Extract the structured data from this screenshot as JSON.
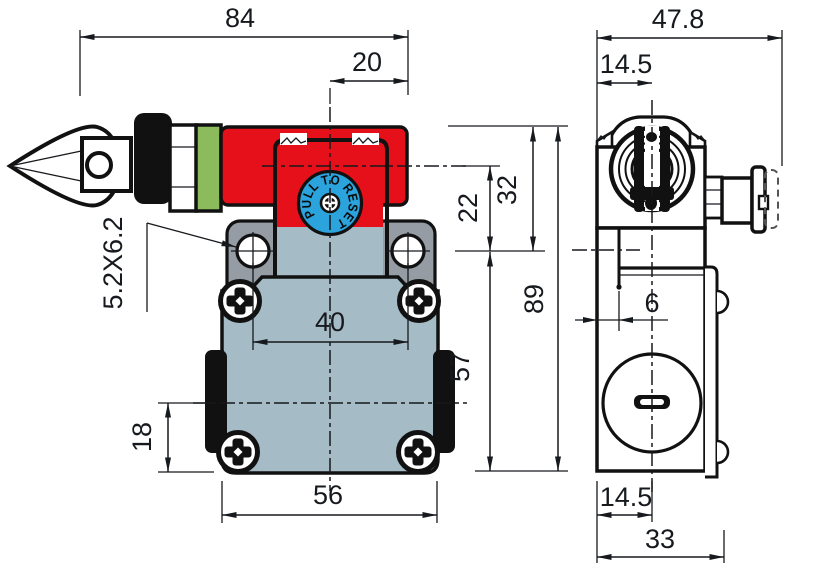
{
  "colors": {
    "red": "#e51019",
    "green": "#8cbb5b",
    "blue": "#2ba3dd",
    "plate_gray": "#959ca4",
    "body_gray": "#a5bbc5",
    "line": "#16191d"
  },
  "front_view": {
    "knob_label": "PULL TO RESET",
    "dimensions": {
      "overall_width": "84",
      "knob_to_right": "20",
      "slot_hole": "5.2X6.2",
      "hole_spacing": "40",
      "body_width": "56",
      "tab_to_bottom": "18",
      "axis_to_holes": "22",
      "top_to_holes": "32",
      "overall_height": "89",
      "holes_to_bottom": "57"
    }
  },
  "side_view": {
    "dimensions": {
      "overall_depth": "47.8",
      "top_offset": "14.5",
      "step_offset": "6",
      "bottom_offset": "14.5",
      "body_depth": "33"
    }
  }
}
